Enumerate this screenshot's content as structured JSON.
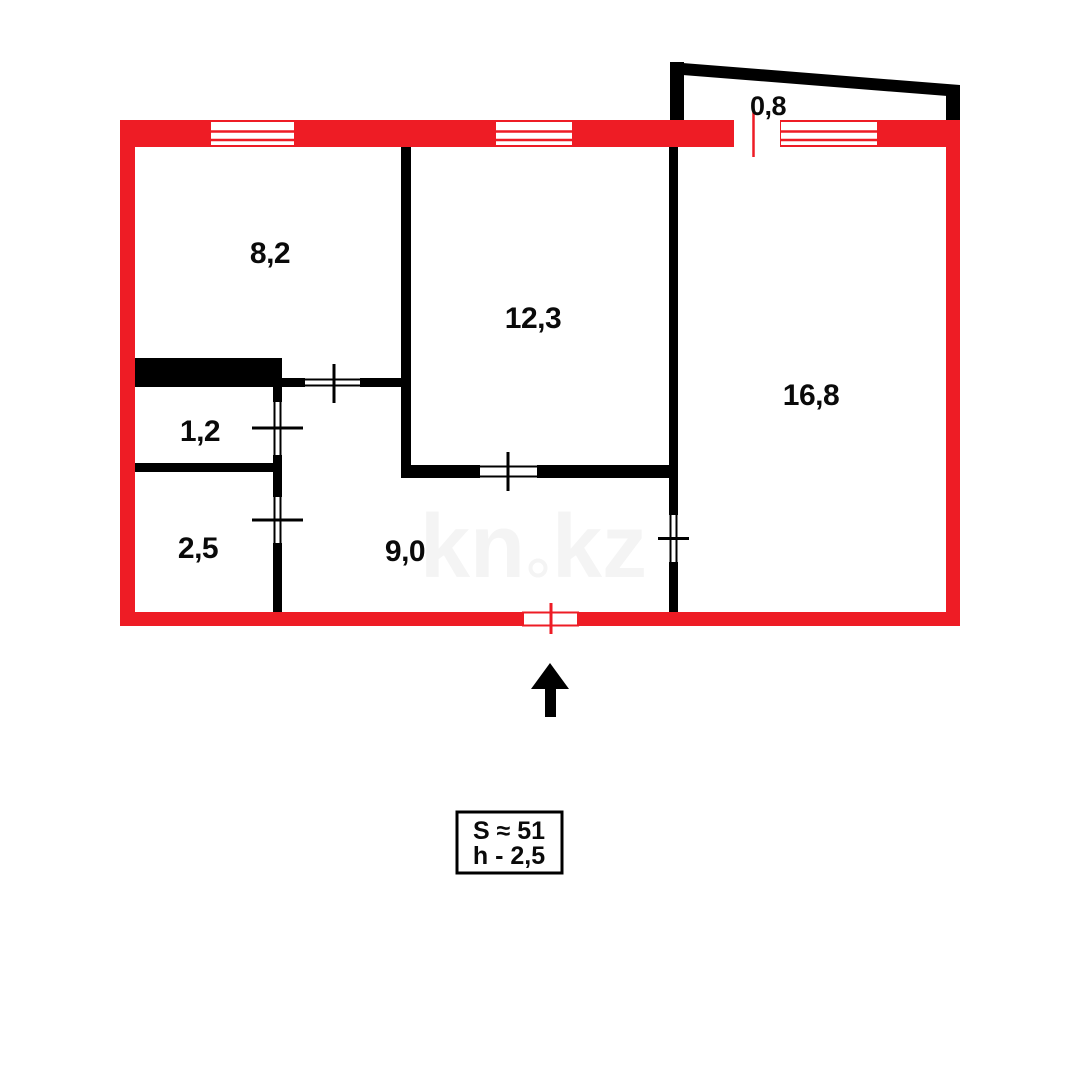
{
  "colors": {
    "outer_wall_red": "#ee1c25",
    "inner_wall_black": "#000000",
    "watermark_gray": "#f4f4f4",
    "background": "#ffffff"
  },
  "plan": {
    "rooms": [
      {
        "name": "room-top-left",
        "label": "8,2"
      },
      {
        "name": "room-top-middle",
        "label": "12,3"
      },
      {
        "name": "room-right",
        "label": "16,8"
      },
      {
        "name": "storage-room",
        "label": "1,2"
      },
      {
        "name": "bathroom",
        "label": "2,5"
      },
      {
        "name": "hallway",
        "label": "9,0"
      },
      {
        "name": "balcony",
        "label": "0,8"
      }
    ]
  },
  "legend": {
    "total_area": "S ≈ 51",
    "ceiling_height": "h - 2,5"
  },
  "watermark": {
    "text": "kn.kz",
    "left": "kn",
    "right": "kz"
  },
  "icons": {
    "north_arrow": "arrow-up-icon"
  }
}
